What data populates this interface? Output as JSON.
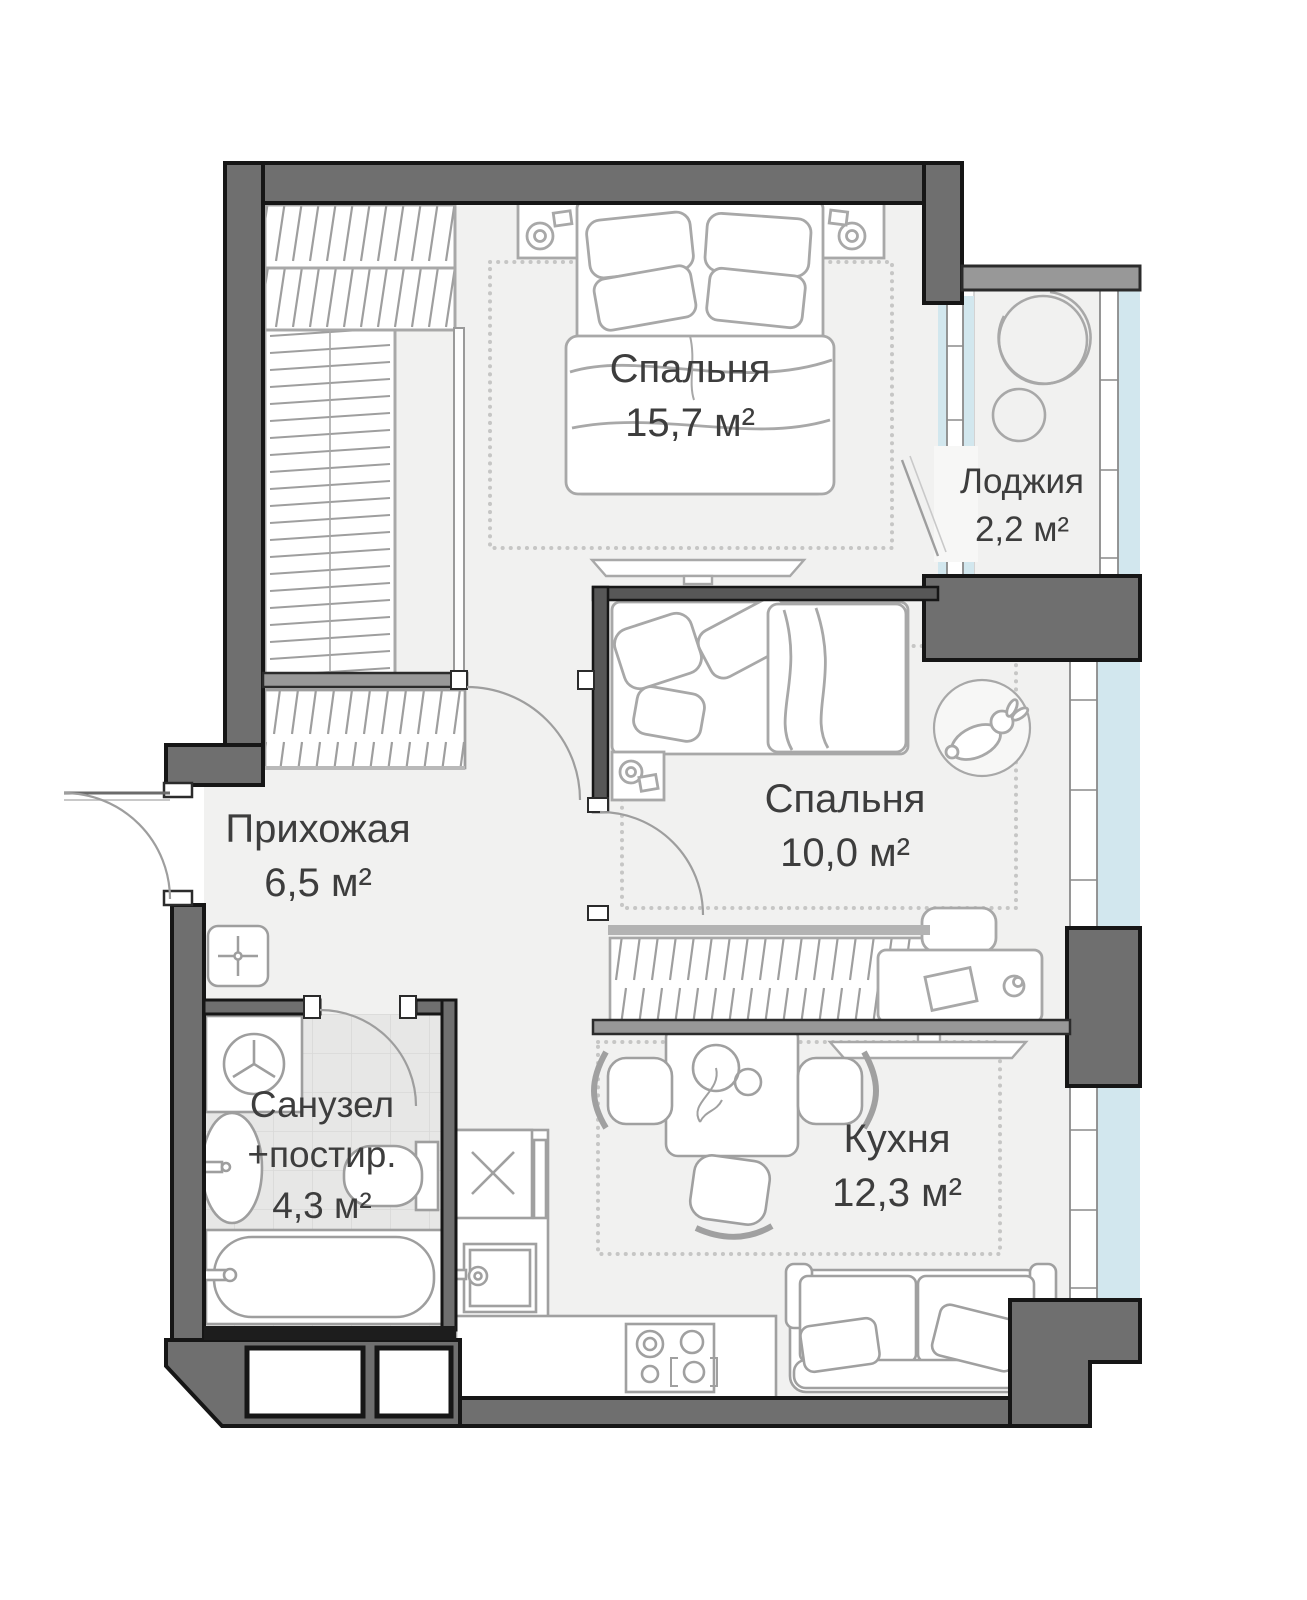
{
  "page": {
    "title": "План квартиры (2-комнатная)"
  },
  "rooms": {
    "bedroom_main": {
      "label": "Спальня",
      "area": "15,7 м²"
    },
    "loggia": {
      "label": "Лоджия",
      "area": "2,2 м²"
    },
    "bedroom_second": {
      "label": "Спальня",
      "area": "10,0 м²"
    },
    "hallway": {
      "label": "Прихожая",
      "area": "6,5 м²"
    },
    "bathroom": {
      "label": "Санузел",
      "label_line2": "+постир.",
      "area": "4,3 м²"
    },
    "kitchen": {
      "label": "Кухня",
      "area": "12,3 м²"
    }
  },
  "colors": {
    "wall_dark": "#6f6f6f",
    "wall_light": "#989898",
    "wall_black": "#1d1d1d",
    "floor": "#f1f1f0",
    "tile": "#e7e7e6",
    "glass": "#d2e7ee",
    "furniture_line": "#a8a8a8",
    "text": "#3d3d3d"
  }
}
